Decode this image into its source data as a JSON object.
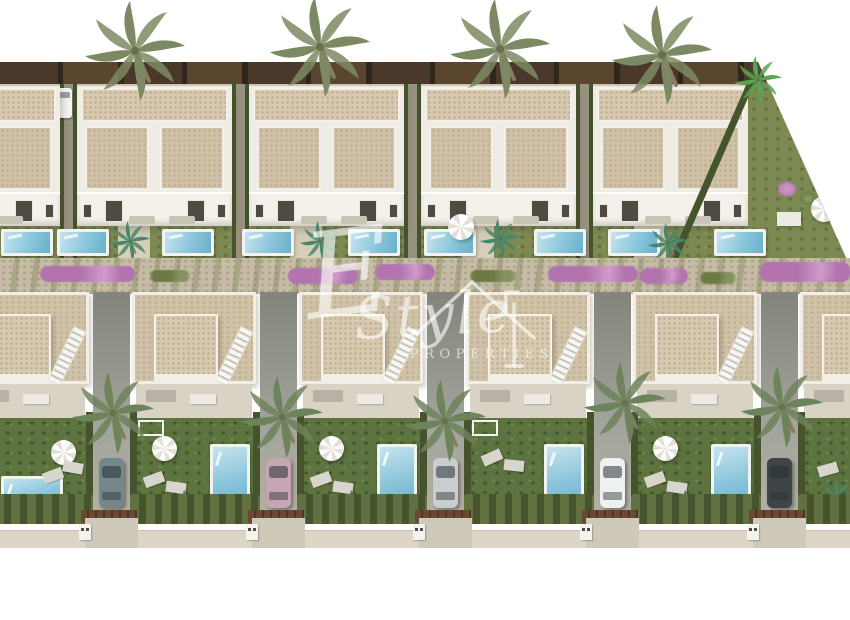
{
  "watermark": {
    "initial": "E",
    "name": "Style",
    "caption": "PROPERTIES"
  },
  "scene": {
    "type": "aerial-3d-render-residential-development",
    "top_row_villas": 5,
    "bottom_row_villas": 6,
    "top_row_pools": 9,
    "bottom_row_pools": 6,
    "parked_cars": 5,
    "parked_vans": 1
  },
  "palette": {
    "sky": "#ffffff",
    "ground": "#d1c8b2",
    "roof": "#d8cab0",
    "roofDot": "#c0ae8e",
    "roofB": "#cfc2a8",
    "facade": "#eeece4",
    "windowDark": "#4e4b42",
    "lawnTop": "#7c8952",
    "lawnLow": "#5d7340",
    "hedge": "#45542c",
    "hedgeL": "#617141",
    "poolRim": "#f2f3ee",
    "water1": "#c6e4ee",
    "water2": "#8cc6db",
    "water3": "#68afc9",
    "gravel": "#c6bca5",
    "moss": "#8e9267",
    "flower": "#b273ae",
    "flowerL": "#d09cc9",
    "fence": "#4a392a",
    "fenceD": "#30261c",
    "drive": "#a2a49b",
    "driveD": "#83857c",
    "sidewalk": "#ddd6c7",
    "gate": "#6b4832",
    "apron": "#cfc9b9",
    "trunk": "#8a7a61",
    "palm": "#7c8963",
    "palmB": "#6d835a",
    "palmTeal": "#47876b",
    "banana": "#5da253",
    "carTeal": "#74888b",
    "carPink": "#c7a6b3",
    "carSilver": "#c9cdd0",
    "carWhite": "#eef0f1",
    "carDark": "#3f4447",
    "watermark": "rgba(255,255,255,0.62)"
  }
}
